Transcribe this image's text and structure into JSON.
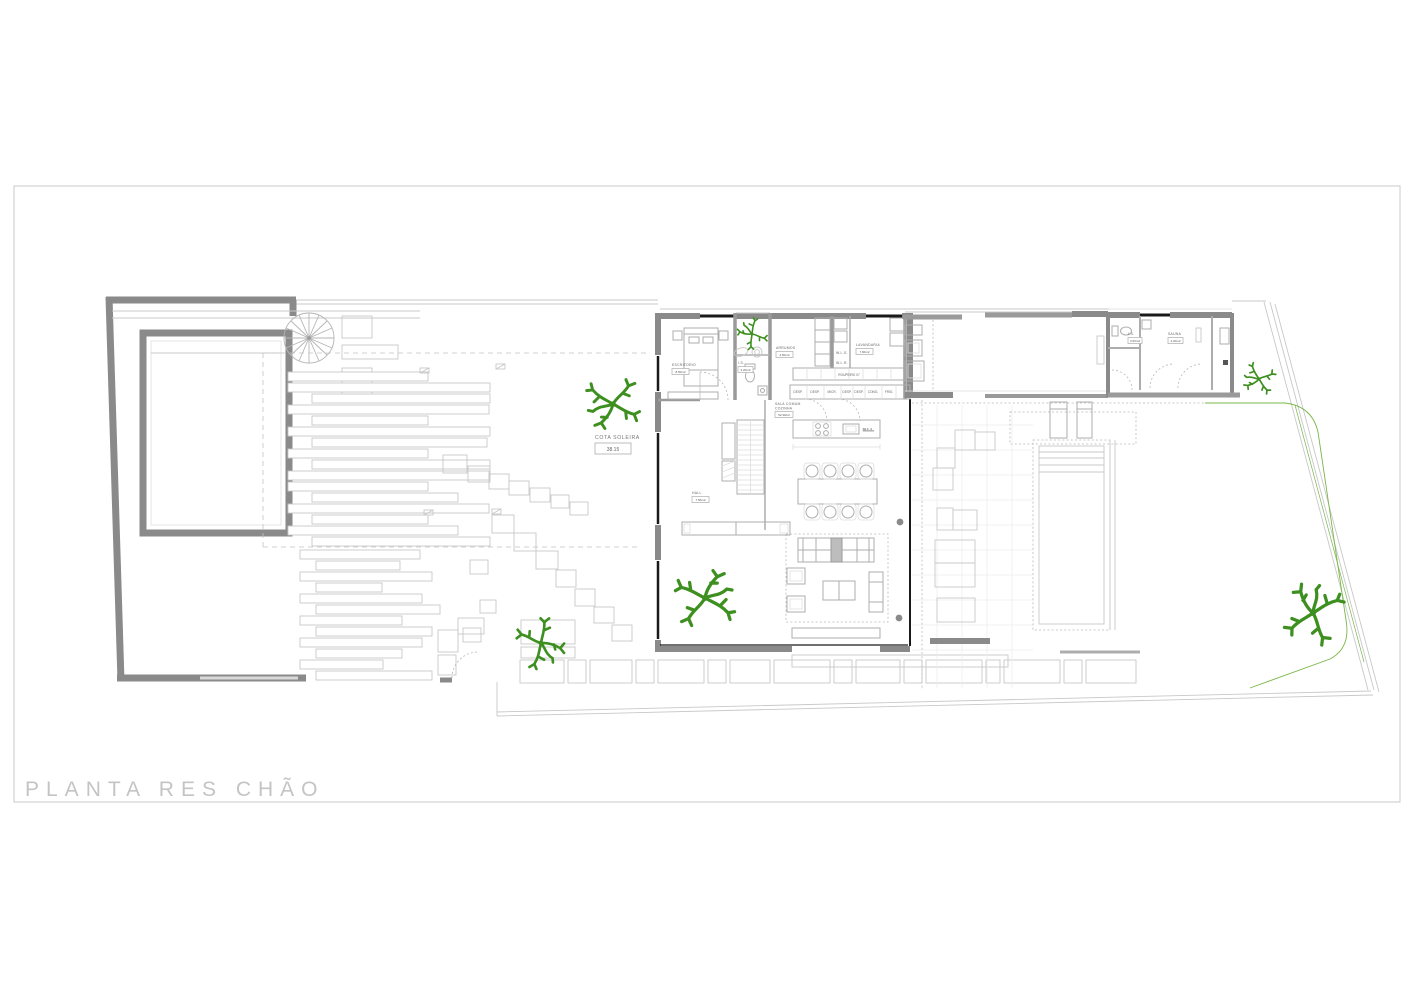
{
  "page": {
    "title": "PLANTA RES CHÃO"
  },
  "plan": {
    "cota": {
      "label": "COTA SOLEIRA",
      "value": "38.15"
    },
    "rooms": {
      "escritorio": {
        "name": "ESCRITORIO",
        "area": "8.50m2"
      },
      "is_west": {
        "name": "I.S.",
        "area": "3.20m2"
      },
      "arrumos": {
        "name": "ARRUMOS",
        "area": "4.50m2"
      },
      "lavandaria": {
        "name": "LAVANDARIA",
        "area": "7.60m2"
      },
      "hall": {
        "name": "HALL",
        "area": "7.50m2"
      },
      "sala": {
        "name_line1": "SALA COMUM",
        "name_line2": "COZINHA",
        "area": "52.30m2"
      },
      "is_east": {
        "name": "I.S.",
        "area": "3.00m2"
      },
      "sauna": {
        "name": "SAUNA",
        "area": "4.20m2"
      }
    },
    "closets": {
      "wls": "W.L.S.",
      "wlr": "W.L.R.",
      "roupeiro": "ROUPEIRO 07",
      "mll": "M.L.L."
    },
    "pantry_cells": [
      "DESP.",
      "DESP.",
      "MICR.",
      "DESP.",
      "DESP.",
      "CONG.",
      "FRIG."
    ]
  },
  "colors": {
    "wall_dark": "#8a8a8a",
    "window_black": "#1a1a1a",
    "line_light": "#c8c8c8",
    "tree_green": "#3d8f1f",
    "garden_green": "#7ab648",
    "title_gray": "#c4c4c4"
  }
}
